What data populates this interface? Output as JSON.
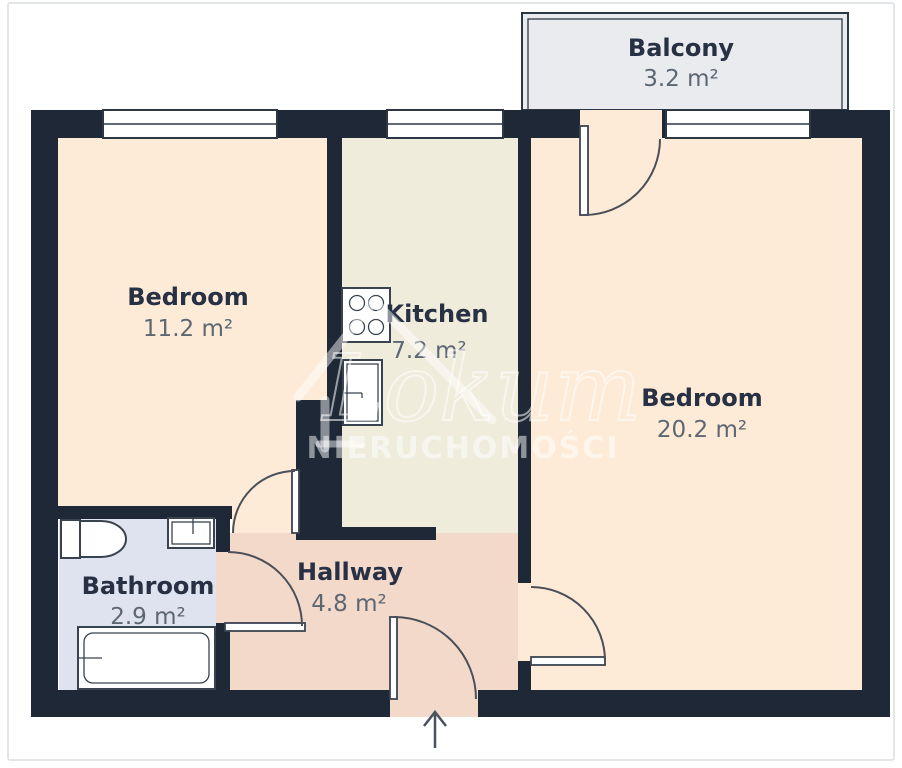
{
  "plan": {
    "rooms": {
      "balcony": {
        "name": "Balcony",
        "area": "3.2 m²"
      },
      "bedroom1": {
        "name": "Bedroom",
        "area": "11.2 m²"
      },
      "kitchen": {
        "name": "Kitchen",
        "area": "7.2 m²"
      },
      "bedroom2": {
        "name": "Bedroom",
        "area": "20.2 m²"
      },
      "bathroom": {
        "name": "Bathroom",
        "area": "2.9 m²"
      },
      "hallway": {
        "name": "Hallway",
        "area": "4.8 m²"
      }
    },
    "fixtures": {
      "stove": "stove-icon",
      "kitchen_sink": "kitchen-sink-icon",
      "toilet": "toilet-icon",
      "bathroom_sink": "bathroom-sink-icon",
      "bathtub": "bathtub-icon",
      "entrance": "entrance-arrow-icon"
    },
    "colors": {
      "wall": "#1e2836",
      "bedroom_floor": "#fdebd7",
      "kitchen_floor": "#efecdc",
      "hallway_floor": "#f3d9ca",
      "bathroom_floor": "#dfe3ef",
      "balcony_floor": "#e9ebee",
      "room_name_text": "#273143",
      "room_area_text": "#5d6773"
    }
  },
  "watermark": {
    "brand": "Lokum",
    "subtitle": "NIERUCHOMOŚCI"
  }
}
